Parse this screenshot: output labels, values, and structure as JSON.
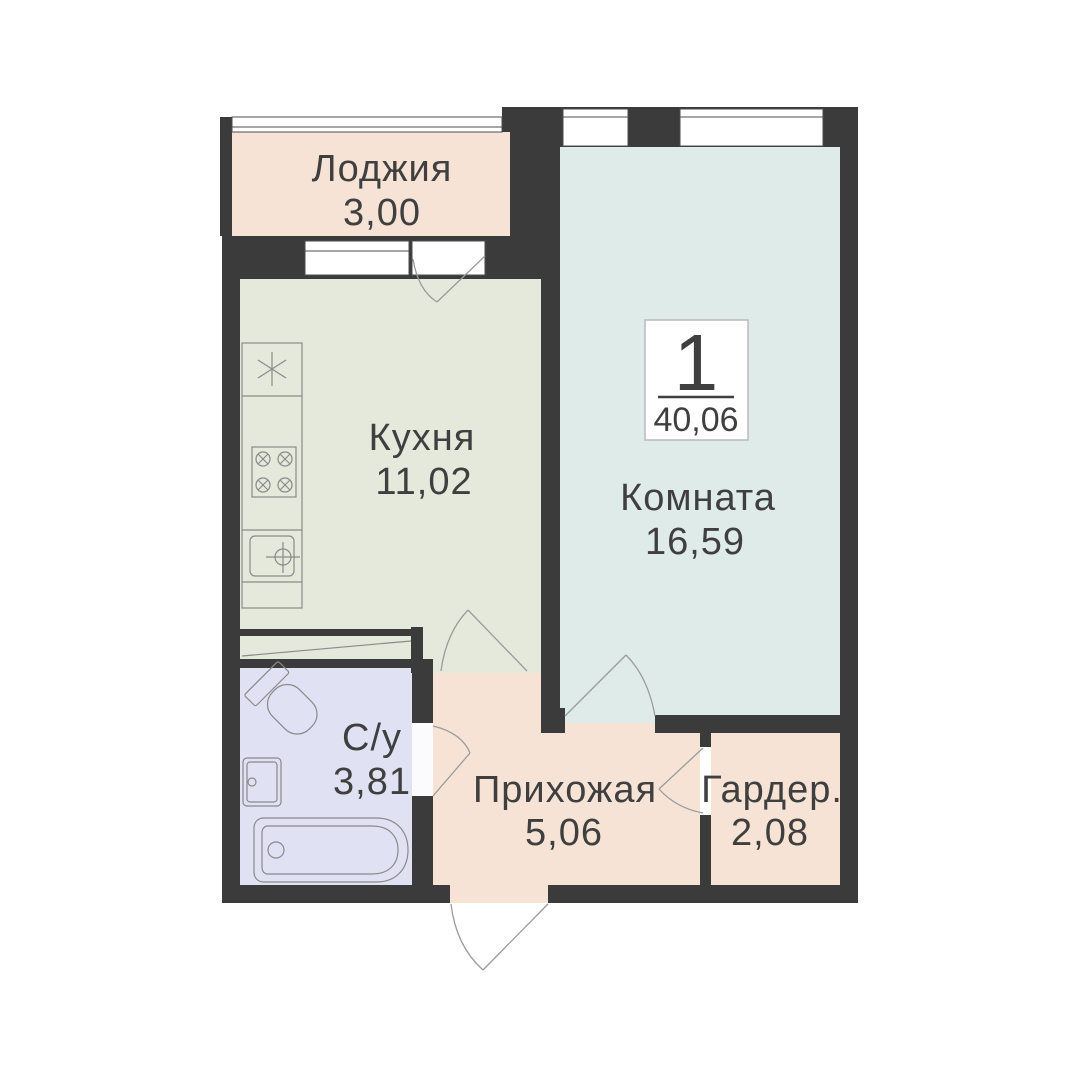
{
  "badge": {
    "number": "1",
    "area": "40,06"
  },
  "rooms": [
    {
      "name": "loggia",
      "label": "Лоджия",
      "area": "3,00"
    },
    {
      "name": "kitchen",
      "label": "Кухня",
      "area": "11,02"
    },
    {
      "name": "room",
      "label": "Комната",
      "area": "16,59"
    },
    {
      "name": "bathroom",
      "label": "С/у",
      "area": "3,81"
    },
    {
      "name": "hallway",
      "label": "Прихожая",
      "area": "5,06"
    },
    {
      "name": "wardrobe",
      "label": "Гардер.",
      "area": "2,08"
    }
  ],
  "colors": {
    "background": "#ffffff",
    "wall": "#3b3b3b",
    "loggia_floor": "#f6e3d5",
    "kitchen_floor": "#e4e9db",
    "room_floor": "#deebe8",
    "bathroom_floor": "#e0e2f3",
    "hallway_floor": "#f6e3d5",
    "wardrobe_floor": "#f6e3d5",
    "door_swing_line": "#9b9b9b",
    "fixture_line": "#8a8a8a",
    "text": "#3f3f3f",
    "badge_border": "#b9b9b9"
  }
}
